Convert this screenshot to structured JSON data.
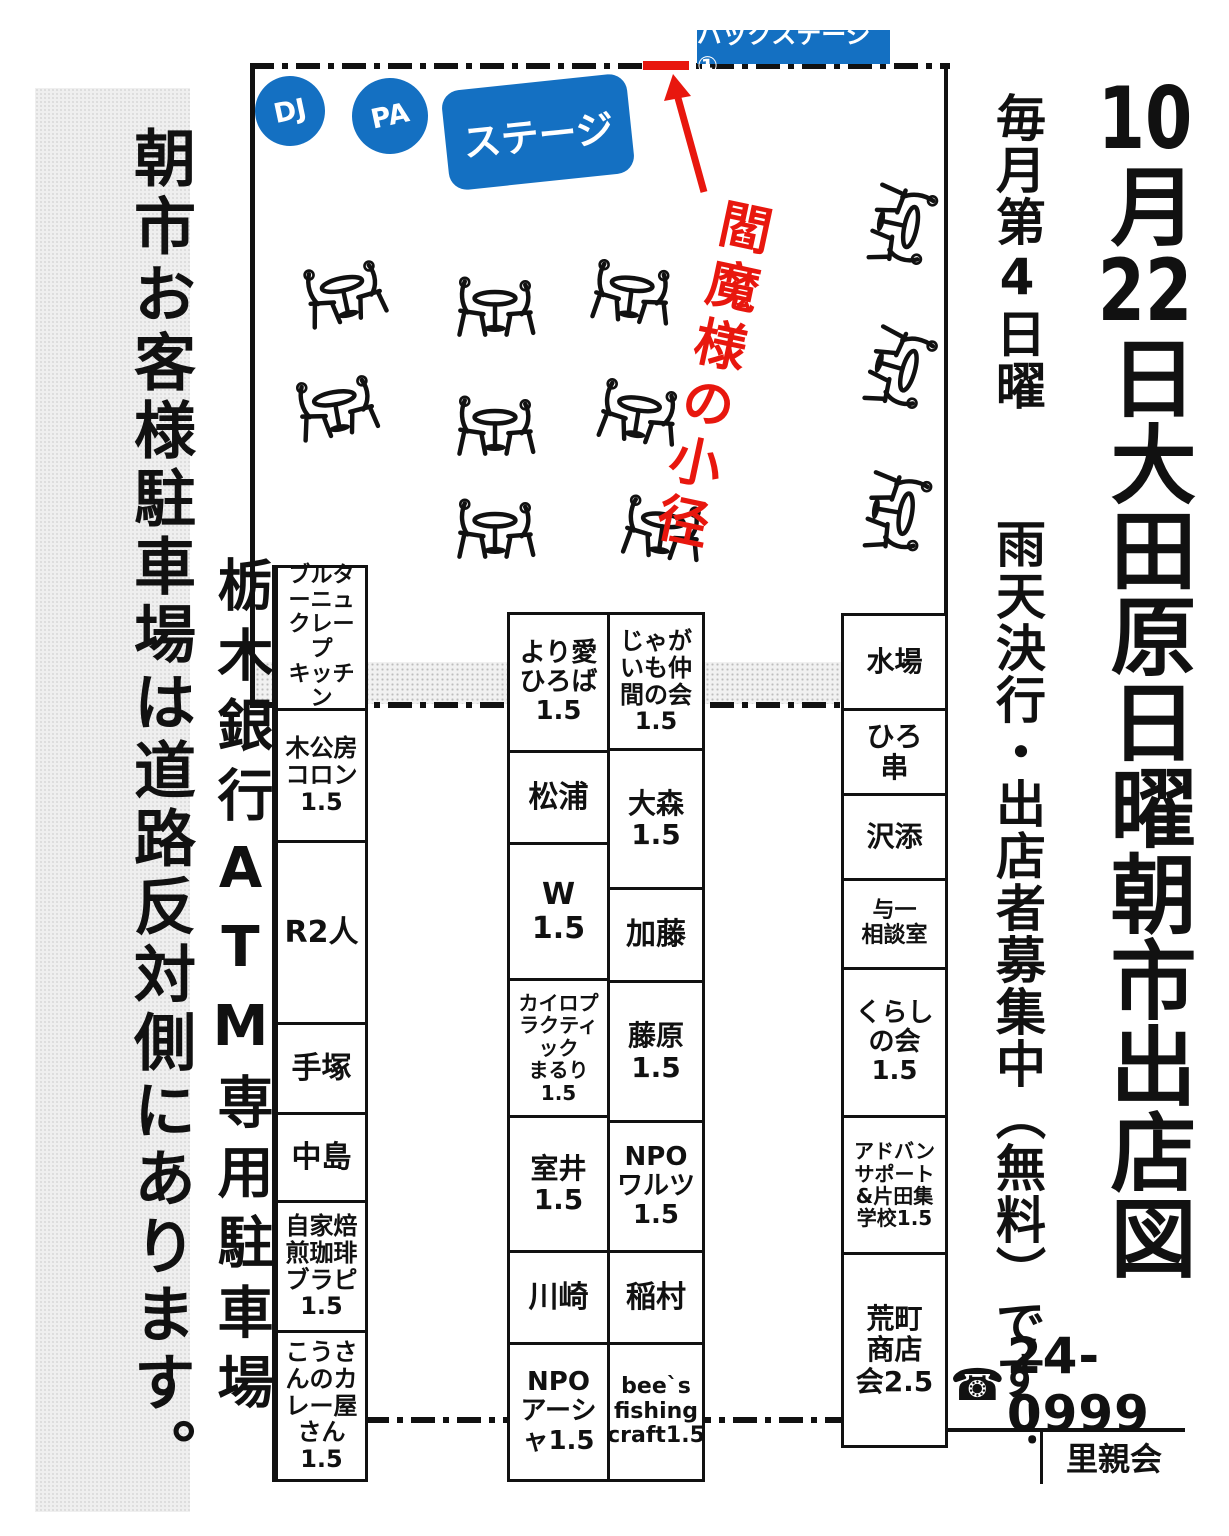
{
  "notices": {
    "customer_parking": "朝市お客様駐車場は道路反対側にあります。",
    "atm_parking": "栃木銀行ATM専用駐車場"
  },
  "stage": {
    "dj": "DJ",
    "pa": "PA",
    "stage_label": "ステージ",
    "backstage": "バックステージ①",
    "path_label": "閻魔様の小径"
  },
  "info": {
    "schedule": "毎月第4日曜",
    "recruit": "雨天決行・出店者募集中（無料）です！",
    "title_parts": [
      "10",
      "月",
      "22",
      "日",
      "大田原日曜朝市出店図"
    ],
    "phone": "24-0999",
    "org": "里親会"
  },
  "icons": {
    "phone": "☎"
  },
  "colors": {
    "accent_blue": "#1470c2",
    "accent_red": "#e8170e",
    "line_black": "#111111"
  },
  "booths": {
    "left_column": [
      "ブルターニュ\nクレープ\nキッチン",
      "木公房コロン1.5",
      "R2人",
      "手塚",
      "中島",
      "自家焙煎珈琲ブラピ1.5",
      "こうさんのカレー屋さん1.5"
    ],
    "mid_left_column": [
      "より愛ひろば1.5",
      "松浦",
      "W\n1.5",
      "カイロプラクティック\nまるり\n1.5",
      "室井\n1.5",
      "川崎",
      "NPO\nアーシャ1.5"
    ],
    "mid_right_column": [
      "じゃがいも仲間の会\n1.5",
      "大森\n1.5",
      "加藤",
      "藤原\n1.5",
      "NPO\nワルツ1.5",
      "稲村",
      "bee`s\nfishing\ncraft1.5"
    ],
    "right_column": [
      "水場",
      "ひろ\n串",
      "沢添",
      "与一\n相談室",
      "くらし\nの会\n1.5",
      "アドバン\nサポート\n&片田集\n学校1.5",
      "荒町\n商店\n会2.5"
    ]
  }
}
